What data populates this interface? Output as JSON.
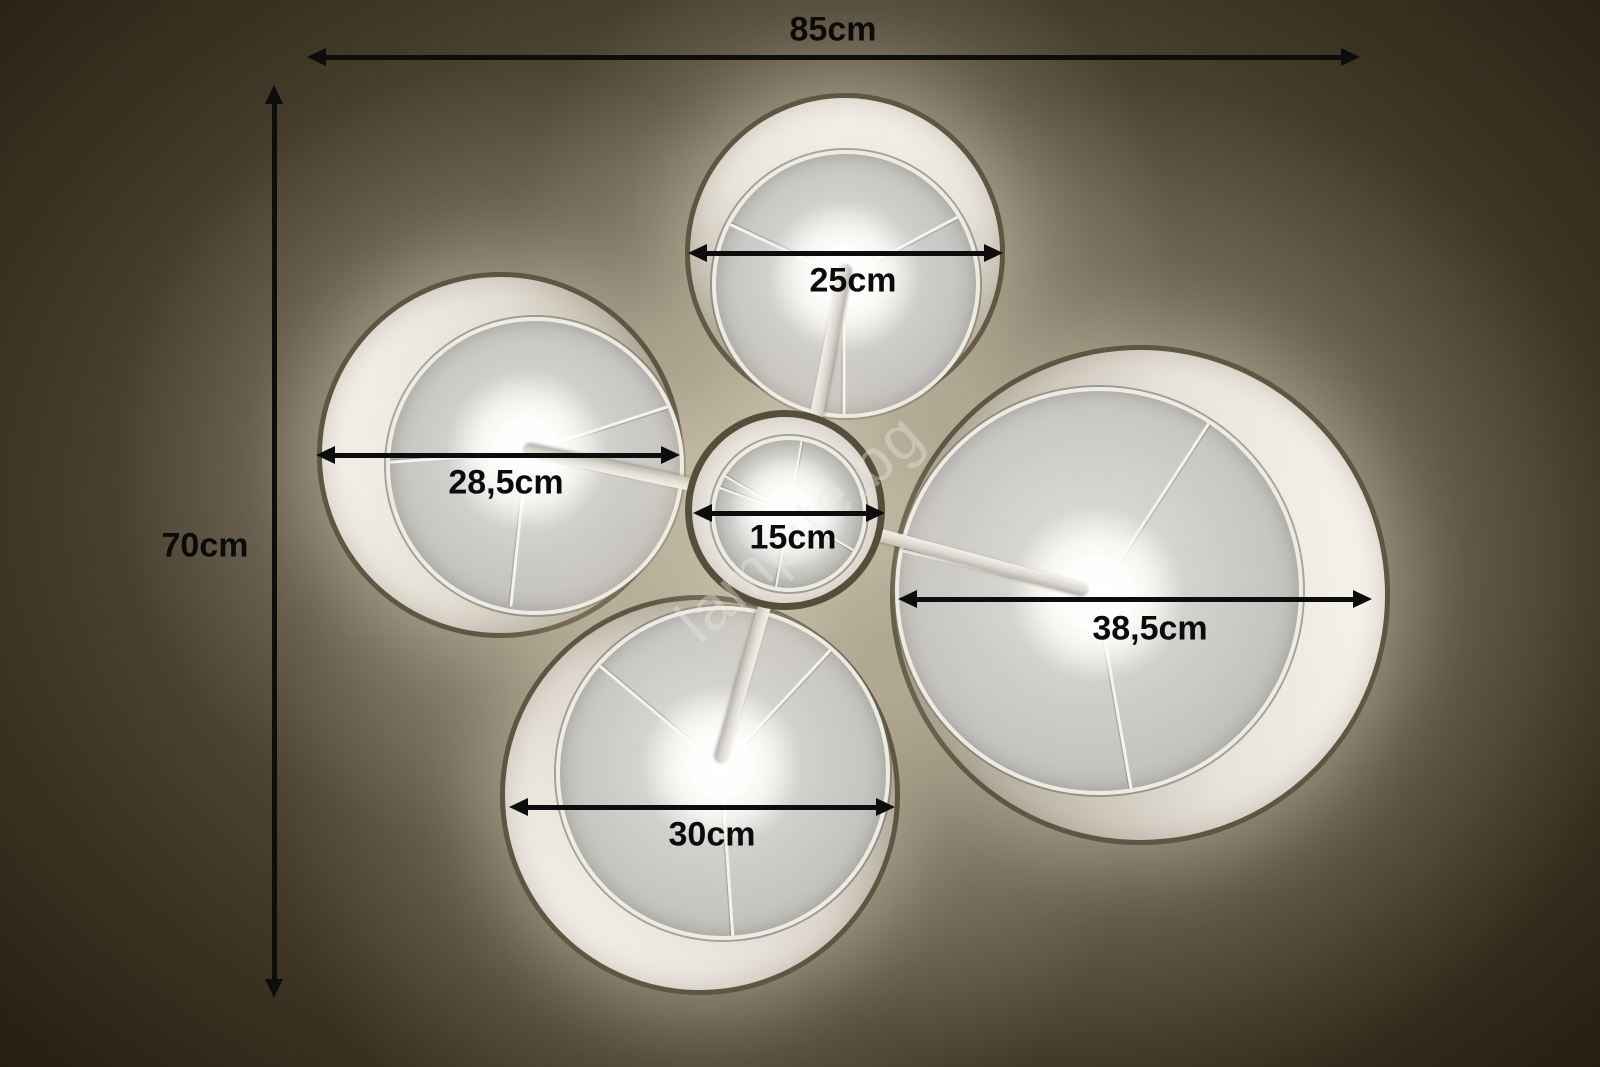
{
  "watermark": "lampite.bg",
  "annotations": {
    "overall_width": "85cm",
    "overall_height": "70cm"
  },
  "shades": [
    {
      "id": "top",
      "diameter_label": "25cm"
    },
    {
      "id": "left",
      "diameter_label": "28,5cm"
    },
    {
      "id": "center",
      "diameter_label": "15cm"
    },
    {
      "id": "right",
      "diameter_label": "38,5cm"
    },
    {
      "id": "bottom",
      "diameter_label": "30cm"
    }
  ],
  "colors": {
    "annotation": "#0d0d0d",
    "fabric": "#f0ede6",
    "ceiling_through_shade": "#c9c7c4",
    "background_dark": "#221c0e"
  }
}
